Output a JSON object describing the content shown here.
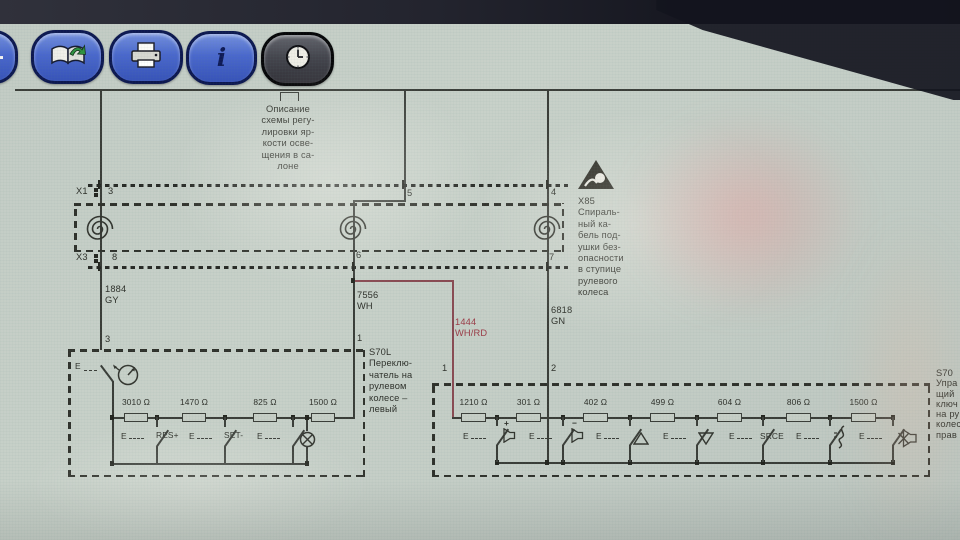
{
  "toolbar": {
    "info_glyph": "i",
    "buttons": [
      "partial-hidden",
      "manuals-book",
      "print",
      "info",
      "history-clock"
    ]
  },
  "e_letter": "E",
  "note_lines": [
    "Описание",
    "схемы регу-",
    "лировки яр-",
    "кости осве-",
    "щения в са-",
    "лоне"
  ],
  "connectors": {
    "x1": {
      "label": "X1",
      "pins": [
        "3",
        "5",
        "4"
      ]
    },
    "x3": {
      "label": "X3",
      "pins": [
        "8",
        "6",
        "7"
      ]
    }
  },
  "x85": {
    "lines": [
      "X85",
      "Спираль-",
      "ный ка-",
      "бель под-",
      "ушки без-",
      "опасности",
      "в ступице",
      "рулевого",
      "колеса"
    ]
  },
  "wires": {
    "left": {
      "num": "1884",
      "color": "GY"
    },
    "mid": {
      "num": "7556",
      "color": "WH"
    },
    "branch": {
      "num": "1444",
      "color": "WH/RD"
    },
    "right": {
      "num": "6818",
      "color": "GN"
    }
  },
  "s70l": {
    "pin_top": "3",
    "pin_right": "1",
    "lines": [
      "S70L",
      "Переклю-",
      "чатель на",
      "рулевом",
      "колесе –",
      "левый"
    ],
    "resistors": [
      "3010",
      "1470",
      "825",
      "1500"
    ],
    "unit": "Ω",
    "labels": [
      "RES+",
      "SET-"
    ]
  },
  "s70r": {
    "pin_left": "1",
    "pin_right": "2",
    "resistors": [
      "1210",
      "301",
      "402",
      "499",
      "604",
      "806",
      "1500"
    ],
    "unit": "Ω",
    "srce_label": "SRCE",
    "plus": "+",
    "minus": "−",
    "icons": [
      "volume-up-speaker",
      "volume-down-speaker",
      "seek-up-triangle",
      "seek-down-triangle",
      "source-label",
      "voice-squiggle",
      "mute-speaker"
    ]
  },
  "s70_right_fragment": {
    "lines": [
      "S70",
      "Упра",
      "щий",
      "ключ",
      "на ру",
      "колес",
      "прав"
    ]
  },
  "colors": {
    "highlight_wire": "#9c3a46",
    "line": "#3a3d38",
    "toolbar_blue": "#4f74d0"
  }
}
